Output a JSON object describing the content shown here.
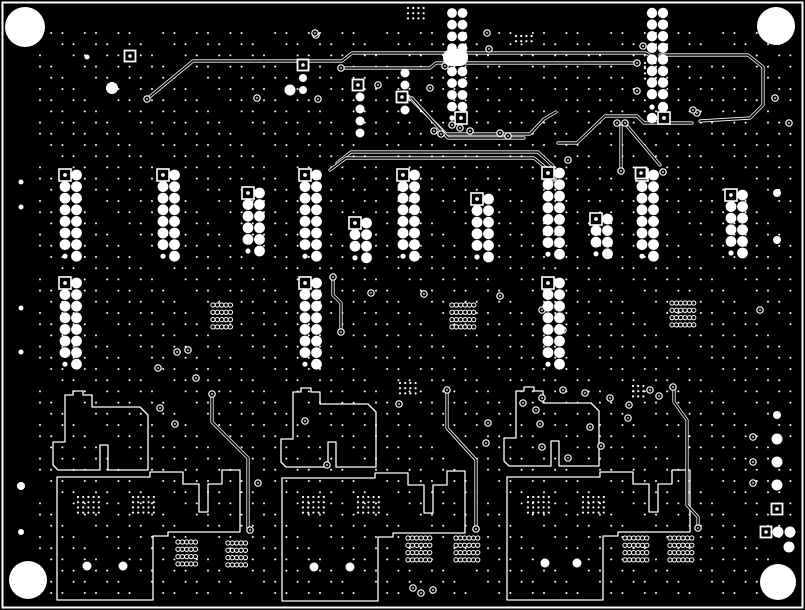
{
  "canvas": {
    "width": 805,
    "height": 610
  },
  "colors": {
    "background": "#000000",
    "copper": "#ffffff"
  },
  "frame": {
    "x": 2.5,
    "y": 2.5,
    "w": 800,
    "h": 605,
    "stroke_width": 2
  },
  "mounting_holes": [
    {
      "x": 25,
      "y": 27,
      "r": 20
    },
    {
      "x": 776,
      "y": 26,
      "r": 19
    },
    {
      "x": 28,
      "y": 580,
      "r": 19
    },
    {
      "x": 778,
      "y": 582,
      "r": 18
    }
  ],
  "dot_grid": {
    "x0": 40,
    "y0": 33,
    "dx": 11.2,
    "dy": 11.2,
    "cols": 68,
    "rows": 51,
    "r": 1.0
  },
  "tight_grids": [
    {
      "x": 408,
      "y": 8,
      "cols": 4,
      "rows": 3
    },
    {
      "x": 516,
      "y": 36,
      "cols": 4,
      "rows": 2
    },
    {
      "x": 645,
      "y": 63,
      "cols": 4,
      "rows": 4
    },
    {
      "x": 400,
      "y": 383,
      "cols": 4,
      "rows": 3
    },
    {
      "x": 633,
      "y": 386,
      "cols": 3,
      "rows": 3
    },
    {
      "x": 78,
      "y": 497,
      "cols": 5,
      "rows": 4
    },
    {
      "x": 133,
      "y": 497,
      "cols": 5,
      "rows": 4
    },
    {
      "x": 303,
      "y": 497,
      "cols": 5,
      "rows": 4
    },
    {
      "x": 358,
      "y": 497,
      "cols": 5,
      "rows": 4
    },
    {
      "x": 528,
      "y": 497,
      "cols": 5,
      "rows": 4
    },
    {
      "x": 583,
      "y": 497,
      "cols": 5,
      "rows": 4
    }
  ],
  "tight_grid_style": {
    "d": 5.2,
    "r": 1.1
  },
  "ring_clusters": [
    {
      "x": 213,
      "y": 305,
      "cols": 5,
      "rows": 4
    },
    {
      "x": 452,
      "y": 305,
      "cols": 6,
      "rows": 4
    },
    {
      "x": 672,
      "y": 303,
      "cols": 6,
      "rows": 4
    },
    {
      "x": 178,
      "y": 542,
      "cols": 5,
      "rows": 4
    },
    {
      "x": 228,
      "y": 543,
      "cols": 5,
      "rows": 4
    },
    {
      "x": 408,
      "y": 538,
      "cols": 6,
      "rows": 4
    },
    {
      "x": 456,
      "y": 538,
      "cols": 6,
      "rows": 4
    },
    {
      "x": 625,
      "y": 538,
      "cols": 6,
      "rows": 4
    },
    {
      "x": 670,
      "y": 538,
      "cols": 6,
      "rows": 4
    }
  ],
  "ring_cluster_style": {
    "dx": 4.35,
    "dy": 7.3,
    "r": 2.15
  },
  "pad_columns": [
    {
      "x": 65,
      "y": 175,
      "rows": 8
    },
    {
      "x": 163,
      "y": 175,
      "rows": 8
    },
    {
      "x": 248,
      "y": 193,
      "rows": 6
    },
    {
      "x": 305,
      "y": 175,
      "rows": 8
    },
    {
      "x": 355,
      "y": 223,
      "rows": 4
    },
    {
      "x": 403,
      "y": 175,
      "rows": 8
    },
    {
      "x": 477,
      "y": 199,
      "rows": 6
    },
    {
      "x": 548,
      "y": 173,
      "rows": 8
    },
    {
      "x": 596,
      "y": 219,
      "rows": 4
    },
    {
      "x": 642,
      "y": 175,
      "rows": 8
    },
    {
      "x": 731,
      "y": 195,
      "rows": 6
    },
    {
      "x": 65,
      "y": 283,
      "rows": 8
    },
    {
      "x": 305,
      "y": 283,
      "rows": 8
    },
    {
      "x": 548,
      "y": 283,
      "rows": 8
    }
  ],
  "pad_column_style": {
    "col_gap": 11.5,
    "row_gap": 11.6,
    "r": 5.4,
    "small_r": 2.6,
    "square": 12
  },
  "top_columns": [
    {
      "x": 452,
      "y": 13,
      "rows": 9,
      "col_gap": 10.5,
      "row_gap": 11.7,
      "r": 4.9
    },
    {
      "x": 652,
      "y": 13,
      "rows": 8,
      "col_gap": 11.0,
      "row_gap": 11.6,
      "r": 5.2
    }
  ],
  "top_column_extras": {
    "blob": {
      "x": 443,
      "y": 49,
      "w": 25,
      "h": 17,
      "rx": 8
    },
    "small_dots": [
      [
        452,
        118
      ],
      [
        652,
        107
      ]
    ],
    "big_dots": [
      [
        663,
        107
      ],
      [
        652,
        118
      ]
    ],
    "squares": [
      [
        461,
        118
      ],
      [
        664,
        118
      ]
    ]
  },
  "squares": [
    [
      130,
      56
    ],
    [
      303,
      65
    ],
    [
      358,
      85
    ],
    [
      402,
      97
    ],
    [
      641,
      173
    ],
    [
      777,
      509
    ],
    [
      766,
      532
    ]
  ],
  "square_style": {
    "size": 11,
    "dot_r": 1.8
  },
  "solid_dots": [
    [
      87,
      57,
      2.5
    ],
    [
      112,
      88,
      6
    ],
    [
      290,
      90,
      5.5
    ],
    [
      303,
      78,
      4
    ],
    [
      303,
      90,
      4
    ],
    [
      360,
      97,
      4.5
    ],
    [
      360,
      109,
      4.5
    ],
    [
      360,
      121,
      4.5
    ],
    [
      360,
      133,
      4.5
    ],
    [
      405,
      73,
      4.5
    ],
    [
      405,
      85,
      4.5
    ],
    [
      405,
      97,
      4.5
    ],
    [
      405,
      110,
      4.5
    ],
    [
      653,
      174,
      4
    ],
    [
      777,
      193,
      4
    ],
    [
      777,
      240,
      4
    ],
    [
      777,
      415,
      4
    ],
    [
      777,
      439,
      5.5
    ],
    [
      777,
      462,
      5.5
    ],
    [
      777,
      485,
      5.5
    ],
    [
      778,
      532,
      5.5
    ],
    [
      790,
      532,
      5.5
    ],
    [
      789,
      547,
      5.5
    ],
    [
      21,
      182,
      2.5
    ],
    [
      21,
      207,
      2.5
    ],
    [
      21,
      308,
      2.5
    ],
    [
      21,
      352,
      2.5
    ],
    [
      21,
      486,
      4
    ],
    [
      21,
      532,
      3
    ],
    [
      87,
      566,
      4.5
    ],
    [
      123,
      566,
      4.5
    ],
    [
      314,
      567,
      4.5
    ],
    [
      350,
      567,
      4.5
    ],
    [
      545,
      563,
      4.5
    ],
    [
      577,
      563,
      4.5
    ],
    [
      452,
      118,
      2.6
    ]
  ],
  "vias": [
    [
      147,
      99
    ],
    [
      257,
      98
    ],
    [
      316,
      35
    ],
    [
      318,
      99
    ],
    [
      341,
      68
    ],
    [
      378,
      85
    ],
    [
      430,
      88
    ],
    [
      445,
      66
    ],
    [
      487,
      33
    ],
    [
      489,
      49
    ],
    [
      434,
      131
    ],
    [
      441,
      134
    ],
    [
      452,
      125
    ],
    [
      460,
      128
    ],
    [
      470,
      131
    ],
    [
      500,
      133
    ],
    [
      508,
      136
    ],
    [
      315,
      33
    ],
    [
      637,
      63
    ],
    [
      643,
      46
    ],
    [
      637,
      91
    ],
    [
      697,
      113
    ],
    [
      693,
      110
    ],
    [
      617,
      123
    ],
    [
      625,
      123
    ],
    [
      621,
      171
    ],
    [
      663,
      172
    ],
    [
      553,
      178
    ],
    [
      547,
      179
    ],
    [
      568,
      160
    ],
    [
      775,
      98
    ],
    [
      789,
      123
    ],
    [
      760,
      310
    ],
    [
      753,
      437
    ],
    [
      753,
      462
    ],
    [
      753,
      483
    ],
    [
      333,
      277
    ],
    [
      341,
      332
    ],
    [
      371,
      293
    ],
    [
      424,
      294
    ],
    [
      542,
      310
    ],
    [
      500,
      296
    ],
    [
      563,
      330
    ],
    [
      177,
      352
    ],
    [
      188,
      350
    ],
    [
      158,
      368
    ],
    [
      196,
      378
    ],
    [
      160,
      408
    ],
    [
      212,
      394
    ],
    [
      250,
      530
    ],
    [
      305,
      421
    ],
    [
      175,
      424
    ],
    [
      399,
      404
    ],
    [
      447,
      390
    ],
    [
      476,
      529
    ],
    [
      488,
      423
    ],
    [
      540,
      424
    ],
    [
      590,
      427
    ],
    [
      628,
      418
    ],
    [
      673,
      387
    ],
    [
      698,
      528
    ],
    [
      629,
      405
    ],
    [
      486,
      443
    ],
    [
      258,
      483
    ],
    [
      327,
      465
    ],
    [
      601,
      446
    ],
    [
      542,
      447
    ],
    [
      568,
      458
    ],
    [
      563,
      390
    ],
    [
      585,
      393
    ],
    [
      610,
      398
    ],
    [
      536,
      410
    ],
    [
      650,
      390
    ],
    [
      659,
      396
    ],
    [
      542,
      398
    ],
    [
      523,
      403
    ],
    [
      413,
      588
    ],
    [
      421,
      593
    ],
    [
      433,
      590
    ]
  ],
  "via_style": {
    "r": 3.2,
    "center_r": 0.9
  },
  "traces": [
    [
      [
        147,
        99
      ],
      [
        193,
        61
      ],
      [
        342,
        61
      ],
      [
        352,
        53
      ],
      [
        646,
        53
      ],
      [
        652,
        57
      ]
    ],
    [
      [
        341,
        68
      ],
      [
        430,
        68
      ],
      [
        436,
        63
      ],
      [
        633,
        63
      ],
      [
        637,
        63
      ]
    ],
    [
      [
        558,
        143
      ],
      [
        577,
        143
      ],
      [
        605,
        116
      ],
      [
        637,
        116
      ],
      [
        644,
        123
      ],
      [
        692,
        123
      ]
    ],
    [
      [
        621,
        126
      ],
      [
        621,
        168
      ]
    ],
    [
      [
        628,
        127
      ],
      [
        660,
        165
      ]
    ],
    [
      [
        404,
        92
      ],
      [
        446,
        134
      ],
      [
        530,
        134
      ],
      [
        544,
        119
      ],
      [
        556,
        112
      ]
    ],
    [
      [
        412,
        98
      ],
      [
        448,
        138
      ],
      [
        524,
        138
      ]
    ],
    [
      [
        337,
        163
      ],
      [
        351,
        152
      ],
      [
        538,
        152
      ],
      [
        553,
        166
      ],
      [
        553,
        176
      ]
    ],
    [
      [
        330,
        170
      ],
      [
        346,
        158
      ],
      [
        534,
        158
      ],
      [
        546,
        168
      ],
      [
        546,
        177
      ]
    ],
    [
      [
        333,
        279
      ],
      [
        333,
        295
      ],
      [
        341,
        303
      ],
      [
        341,
        330
      ]
    ],
    [
      [
        212,
        395
      ],
      [
        212,
        422
      ],
      [
        248,
        458
      ],
      [
        248,
        528
      ]
    ],
    [
      [
        447,
        392
      ],
      [
        447,
        428
      ],
      [
        476,
        460
      ],
      [
        476,
        527
      ]
    ],
    [
      [
        674,
        390
      ],
      [
        674,
        402
      ],
      [
        687,
        420
      ],
      [
        687,
        505
      ],
      [
        698,
        517
      ],
      [
        698,
        526
      ]
    ],
    [
      [
        660,
        55
      ],
      [
        748,
        55
      ],
      [
        763,
        67
      ],
      [
        763,
        105
      ],
      [
        750,
        118
      ],
      [
        700,
        121
      ]
    ]
  ],
  "trace_style": {
    "outer_w": 3.2,
    "inner_w": 1.6
  },
  "pours": {
    "flag_origins": [
      [
        65,
        395
      ],
      [
        293,
        392
      ],
      [
        516,
        391
      ]
    ],
    "flag_points": [
      [
        0,
        0
      ],
      [
        8,
        0
      ],
      [
        8,
        -4
      ],
      [
        18,
        -4
      ],
      [
        18,
        0
      ],
      [
        27,
        0
      ],
      [
        27,
        12
      ],
      [
        75,
        12
      ],
      [
        83,
        20
      ],
      [
        83,
        75
      ],
      [
        43,
        75
      ],
      [
        43,
        50
      ],
      [
        35,
        50
      ],
      [
        35,
        75
      ],
      [
        -7,
        75
      ],
      [
        -12,
        70
      ],
      [
        -12,
        47
      ],
      [
        0,
        47
      ]
    ],
    "rect_origins": [
      [
        57,
        477
      ],
      [
        282,
        478
      ],
      [
        507,
        477
      ]
    ],
    "rect_path": "M0,0 H93 V-5 H126 V7 H142 V35 H151 V7 H165 V-7 H183 V55 H111 V59 H96 V123 H0 Z",
    "stroke_width": 1.3
  }
}
